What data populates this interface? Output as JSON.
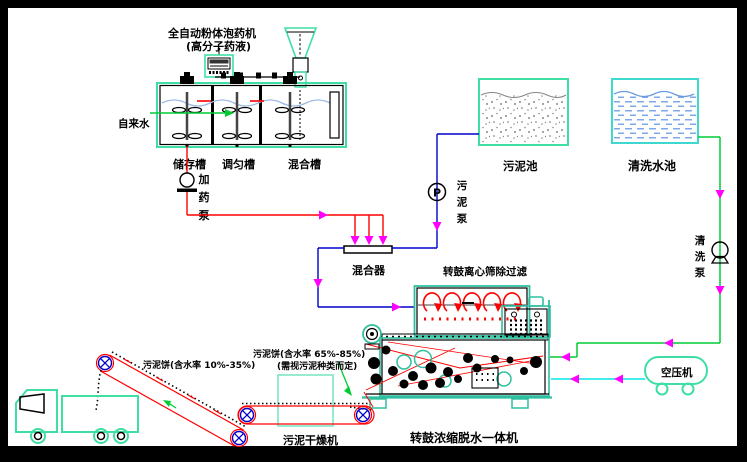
{
  "colors": {
    "frame": "#000000",
    "equipment_green": "#3fdfa4",
    "equipment_teal": "#2fbf9f",
    "dryer_green": "#7de6c3",
    "wash_pool_border": "#3fd8cf",
    "line_red": "#ff0000",
    "line_blue": "#0000cc",
    "line_green": "#00cc33",
    "line_cyan": "#00e5e5",
    "arrow_magenta": "#ff00ff",
    "water_blue": "#8fb0e8",
    "speckle_gray": "#8a8a8a"
  },
  "labels": {
    "feeder_title": "全自动粉体泡药机",
    "feeder_subtitle": "(高分子药液)",
    "tap_water": "自来水",
    "tank1": "储存槽",
    "tank2": "调匀槽",
    "tank3": "混合槽",
    "dosing_pump": "加药泵",
    "mixer": "混合器",
    "pump_p": "P",
    "sludge_pump": "污泥泵",
    "sludge_pool": "污泥池",
    "wash_pool": "清洗水池",
    "wash_pump": "清洗泵",
    "drum_screen": "转鼓离心筛除过滤",
    "air_compressor": "空压机",
    "cake_wet": "污泥饼(含水率 65%-85%)",
    "cake_wet_note": "(需视污泥种类而定)",
    "cake_dry": "污泥饼(含水率 10%-35%)",
    "dryer": "污泥干燥机",
    "dewaterer": "转鼓浓缩脱水一体机"
  }
}
